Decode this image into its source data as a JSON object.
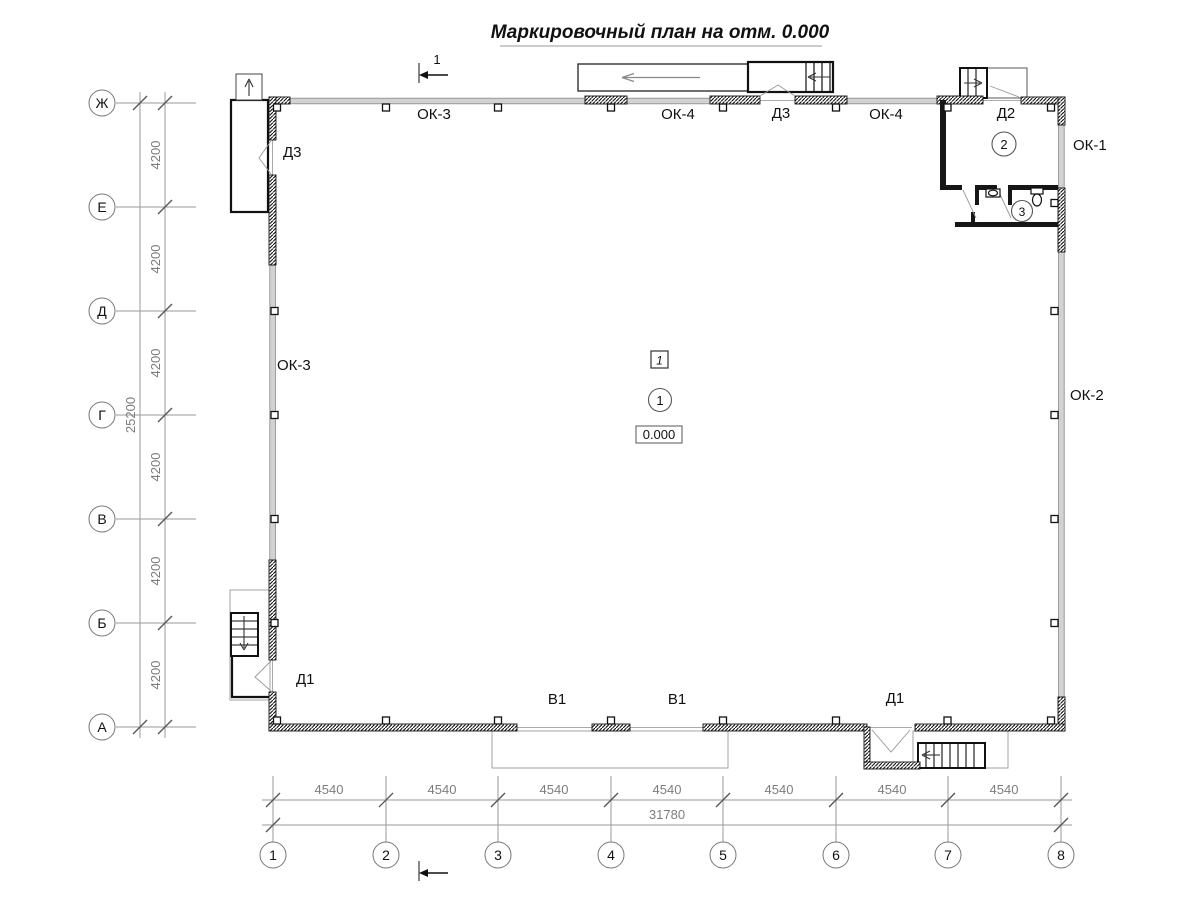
{
  "title": "Маркировочный план на отм. 0.000",
  "palette": {
    "ink": "#111111",
    "dim_gray": "#888888",
    "window_fill": "#d2d2d2"
  },
  "axes": {
    "rows": [
      "Ж",
      "Е",
      "Д",
      "Г",
      "В",
      "Б",
      "А"
    ],
    "cols": [
      "1",
      "2",
      "3",
      "4",
      "5",
      "6",
      "7",
      "8"
    ]
  },
  "dims": {
    "row_segments": [
      "4200",
      "4200",
      "4200",
      "4200",
      "4200",
      "4200"
    ],
    "row_total": "25200",
    "col_segments": [
      "4540",
      "4540",
      "4540",
      "4540",
      "4540",
      "4540",
      "4540"
    ],
    "col_total": "31780"
  },
  "section_mark": {
    "number": "1"
  },
  "labels": {
    "ok3_top": "ОК-3",
    "ok4_left": "ОК-4",
    "d3_top": "Д3",
    "ok4_right": "ОК-4",
    "d2": "Д2",
    "ok1": "ОК-1",
    "d3_left": "Д3",
    "ok3_left": "ОК-3",
    "ok2": "ОК-2",
    "d1_left": "Д1",
    "v1_left": "В1",
    "v1_right": "В1",
    "d1_bottom": "Д1"
  },
  "rooms": {
    "zone_tag": "1",
    "room1": "1",
    "room2": "2",
    "room3": "3",
    "elevation": "0.000"
  }
}
